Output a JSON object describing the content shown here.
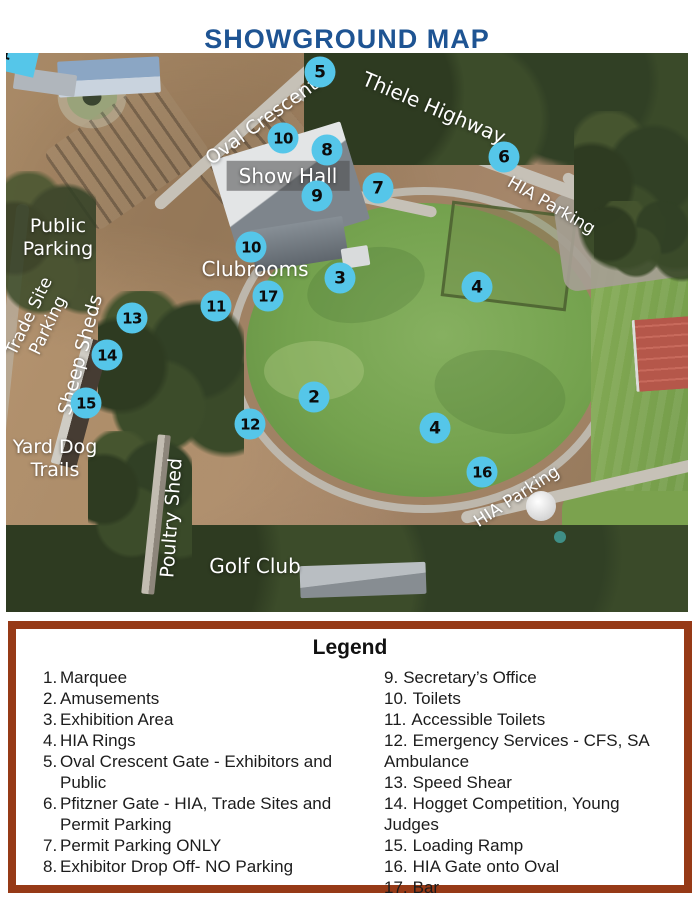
{
  "title": "SHOWGROUND MAP",
  "colors": {
    "title_blue": "#1e5493",
    "marker_blue": "#55c6e9",
    "legend_border": "#963a17"
  },
  "map": {
    "marquee_label": "1",
    "markers": [
      {
        "n": "5",
        "x": 314,
        "y": 19
      },
      {
        "n": "10",
        "x": 277,
        "y": 85
      },
      {
        "n": "8",
        "x": 321,
        "y": 97
      },
      {
        "n": "9",
        "x": 311,
        "y": 143
      },
      {
        "n": "7",
        "x": 372,
        "y": 135
      },
      {
        "n": "6",
        "x": 498,
        "y": 104
      },
      {
        "n": "10",
        "x": 245,
        "y": 194
      },
      {
        "n": "3",
        "x": 334,
        "y": 225
      },
      {
        "n": "4",
        "x": 471,
        "y": 234
      },
      {
        "n": "17",
        "x": 262,
        "y": 243
      },
      {
        "n": "11",
        "x": 210,
        "y": 253
      },
      {
        "n": "13",
        "x": 126,
        "y": 265
      },
      {
        "n": "14",
        "x": 101,
        "y": 302
      },
      {
        "n": "15",
        "x": 80,
        "y": 350
      },
      {
        "n": "2",
        "x": 308,
        "y": 344
      },
      {
        "n": "12",
        "x": 244,
        "y": 371
      },
      {
        "n": "4",
        "x": 429,
        "y": 375
      },
      {
        "n": "16",
        "x": 476,
        "y": 419
      }
    ],
    "labels": [
      {
        "id": "thiele-highway",
        "text": "Thiele Highway",
        "x": 428,
        "y": 55,
        "rot": 23,
        "size": 20
      },
      {
        "id": "oval-crescent",
        "text": "Oval Crescent",
        "x": 256,
        "y": 69,
        "rot": -36,
        "size": 19
      },
      {
        "id": "hia-parking-north",
        "text": "HIA Parking",
        "x": 545,
        "y": 153,
        "rot": 30,
        "size": 17
      },
      {
        "id": "show-hall",
        "text": "Show Hall",
        "x": 282,
        "y": 123,
        "rot": 0,
        "size": 20,
        "boxed": true
      },
      {
        "id": "public-parking",
        "text": "Public\nParking",
        "x": 52,
        "y": 185,
        "rot": 0,
        "size": 19
      },
      {
        "id": "clubrooms",
        "text": "Clubrooms",
        "x": 249,
        "y": 216,
        "rot": 0,
        "size": 20
      },
      {
        "id": "trade-site-parking",
        "text": "Trade Site\nParking",
        "x": 33,
        "y": 268,
        "rot": -64,
        "size": 17
      },
      {
        "id": "sheep-sheds",
        "text": "Sheep Sheds",
        "x": 75,
        "y": 302,
        "rot": -75,
        "size": 19
      },
      {
        "id": "yard-dog-trails",
        "text": "Yard Dog\nTrails",
        "x": 49,
        "y": 406,
        "rot": 0,
        "size": 19
      },
      {
        "id": "poultry-shed",
        "text": "Poultry Shed",
        "x": 166,
        "y": 465,
        "rot": -86,
        "size": 19
      },
      {
        "id": "hia-parking-oval",
        "text": "HIA Parking",
        "x": 511,
        "y": 444,
        "rot": -33,
        "size": 17
      },
      {
        "id": "golf-club",
        "text": "Golf Club",
        "x": 249,
        "y": 513,
        "rot": 0,
        "size": 20
      }
    ]
  },
  "legend": {
    "title": "Legend",
    "left_items": [
      {
        "num": "1.",
        "text": "Marquee"
      },
      {
        "num": "2.",
        "text": "Amusements"
      },
      {
        "num": "3.",
        "text": "Exhibition Area"
      },
      {
        "num": "4.",
        "text": "HIA Rings"
      },
      {
        "num": "5.",
        "text": "Oval Crescent Gate - Exhibitors and\nPublic"
      },
      {
        "num": "6.",
        "text": "Pfitzner Gate - HIA, Trade Sites and\nPermit Parking"
      },
      {
        "num": "7.",
        "text": "Permit Parking ONLY"
      },
      {
        "num": "8.",
        "text": "Exhibitor Drop Off- NO Parking"
      }
    ],
    "right_items": [
      {
        "num": "9.",
        "text": "Secretary’s Office"
      },
      {
        "num": "10.",
        "text": "Toilets"
      },
      {
        "num": "11.",
        "text": "Accessible Toilets"
      },
      {
        "num": "12.",
        "text": "Emergency Services - CFS, SA\nAmbulance"
      },
      {
        "num": "13.",
        "text": "Speed Shear"
      },
      {
        "num": "14.",
        "text": "Hogget Competition, Young Judges"
      },
      {
        "num": "15.",
        "text": "Loading Ramp"
      },
      {
        "num": "16.",
        "text": "HIA Gate onto Oval"
      },
      {
        "num": "17.",
        "text": "Bar"
      }
    ]
  }
}
